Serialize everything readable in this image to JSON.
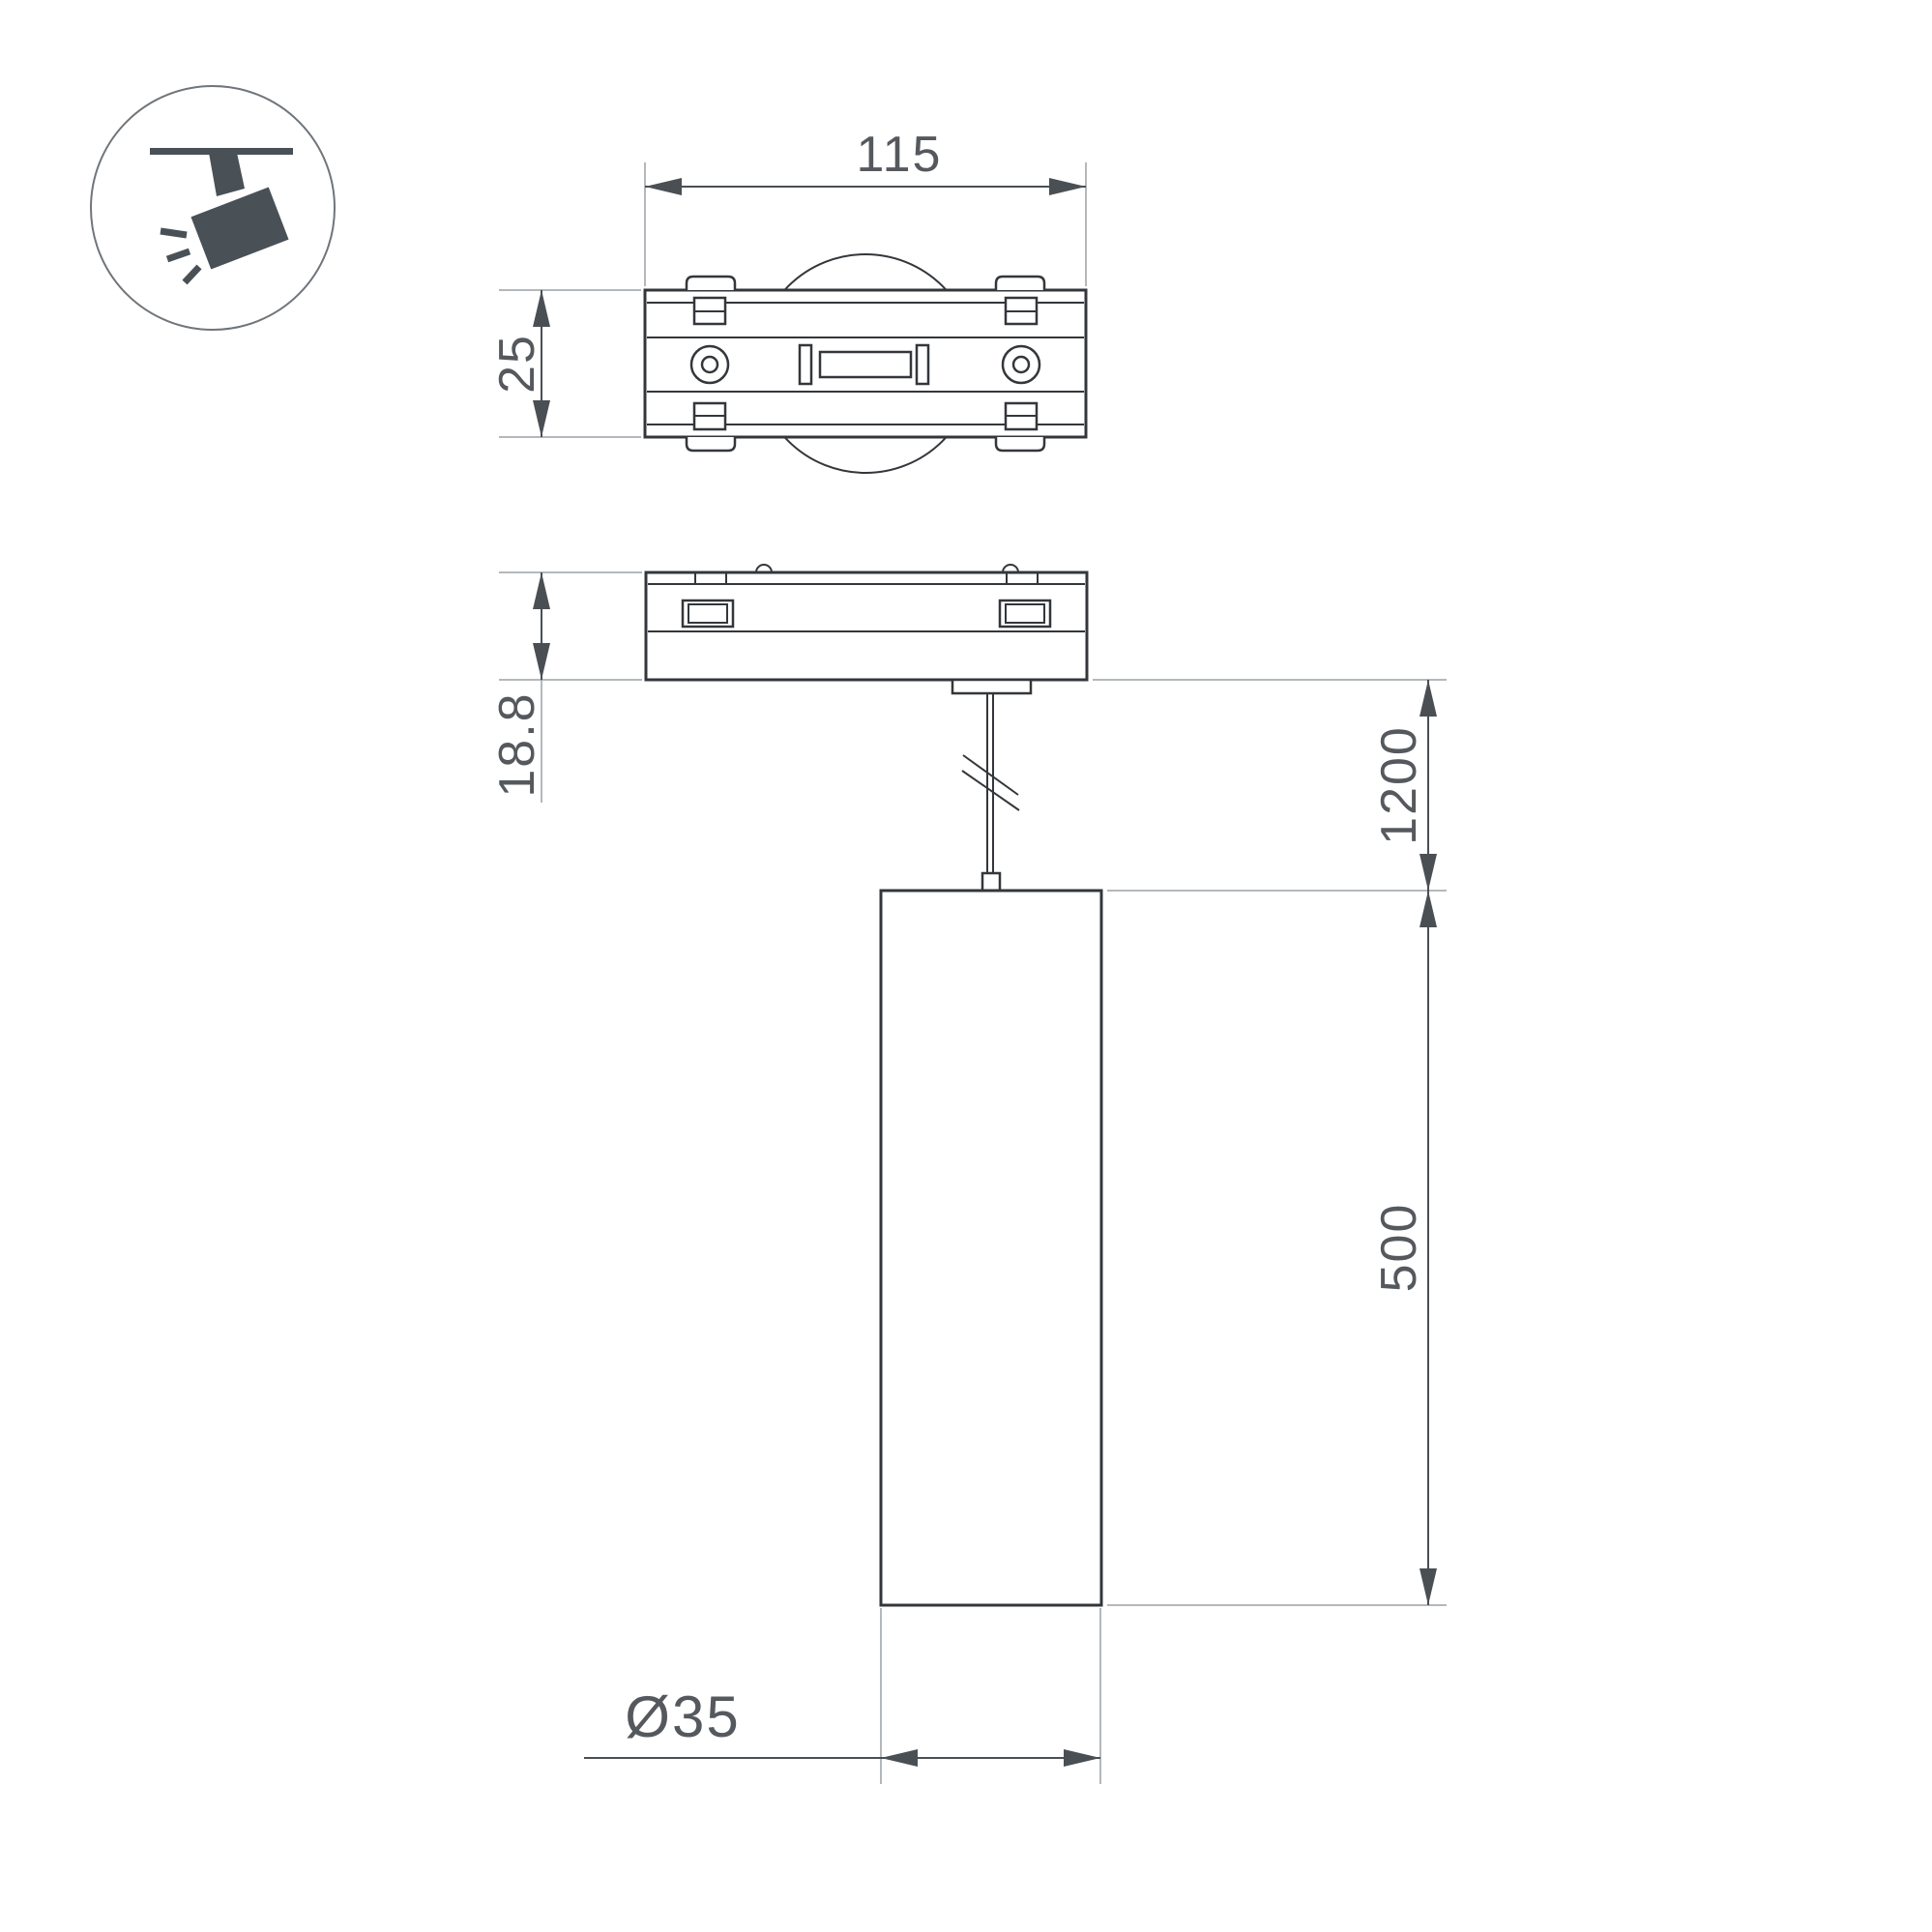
{
  "colors": {
    "ink": "#33373b",
    "dim": "#4a4f54",
    "ext": "#9aa0a5",
    "text": "#55595e",
    "icon": "#495056",
    "circle": "#70757a",
    "bg": "#ffffff"
  },
  "icons": {
    "product_type": "track-spotlight-icon"
  },
  "dimensions": {
    "track_length": "115",
    "track_width": "25",
    "adapter_height": "18.8",
    "suspension_length": "1200",
    "lamp_height": "500",
    "lamp_diameter": "Ø35"
  }
}
